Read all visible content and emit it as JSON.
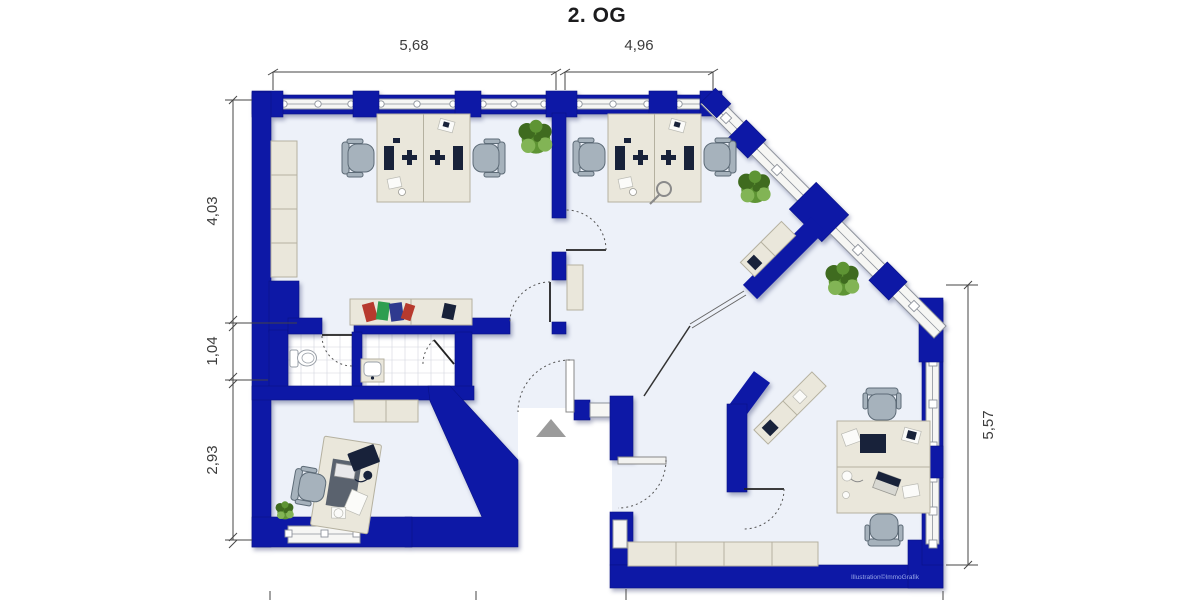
{
  "title": "2. OG",
  "watermark": "Illustration©ImmoGrafik",
  "dimensions": {
    "top": [
      {
        "label": "5,68"
      },
      {
        "label": "4,96"
      }
    ],
    "left": [
      {
        "label": "4,03"
      },
      {
        "label": "1,04"
      },
      {
        "label": "2,93"
      }
    ],
    "right": [
      {
        "label": "5,57"
      }
    ]
  },
  "icons": {
    "entrance_arrow": "entrance-arrow",
    "plant": "potted-plant",
    "toilet": "toilet",
    "sink": "washbasin"
  },
  "colors": {
    "wall": "#0d18a6",
    "wallEdge": "#091287",
    "floor": "#edf1f9",
    "windowFill": "#f6f6f4",
    "windowStroke": "#8d929b",
    "furniture": "#eae7db",
    "furnitureBorder": "#b5b1a0",
    "chair": "#a6b2bc",
    "chairBorder": "#5d6b77",
    "dark": "#18223a",
    "panel": "#5a626e",
    "tileLine": "#d2d6de",
    "fixture": "#ffffff",
    "fixtureStroke": "#9aa0a8",
    "plant": "#5e9434",
    "plantDark": "#3f6b1f",
    "plantLight": "#82b455",
    "bookRed": "#b73a2e",
    "bookGreen": "#2e9e4f",
    "bookNavy": "#2f3a8f",
    "dim": "#454545",
    "titleColor": "#1c1c1e",
    "watermarkColor": "#9aa8e8",
    "arrow": "#9b9b9b",
    "paper": "#fbfbf9"
  }
}
